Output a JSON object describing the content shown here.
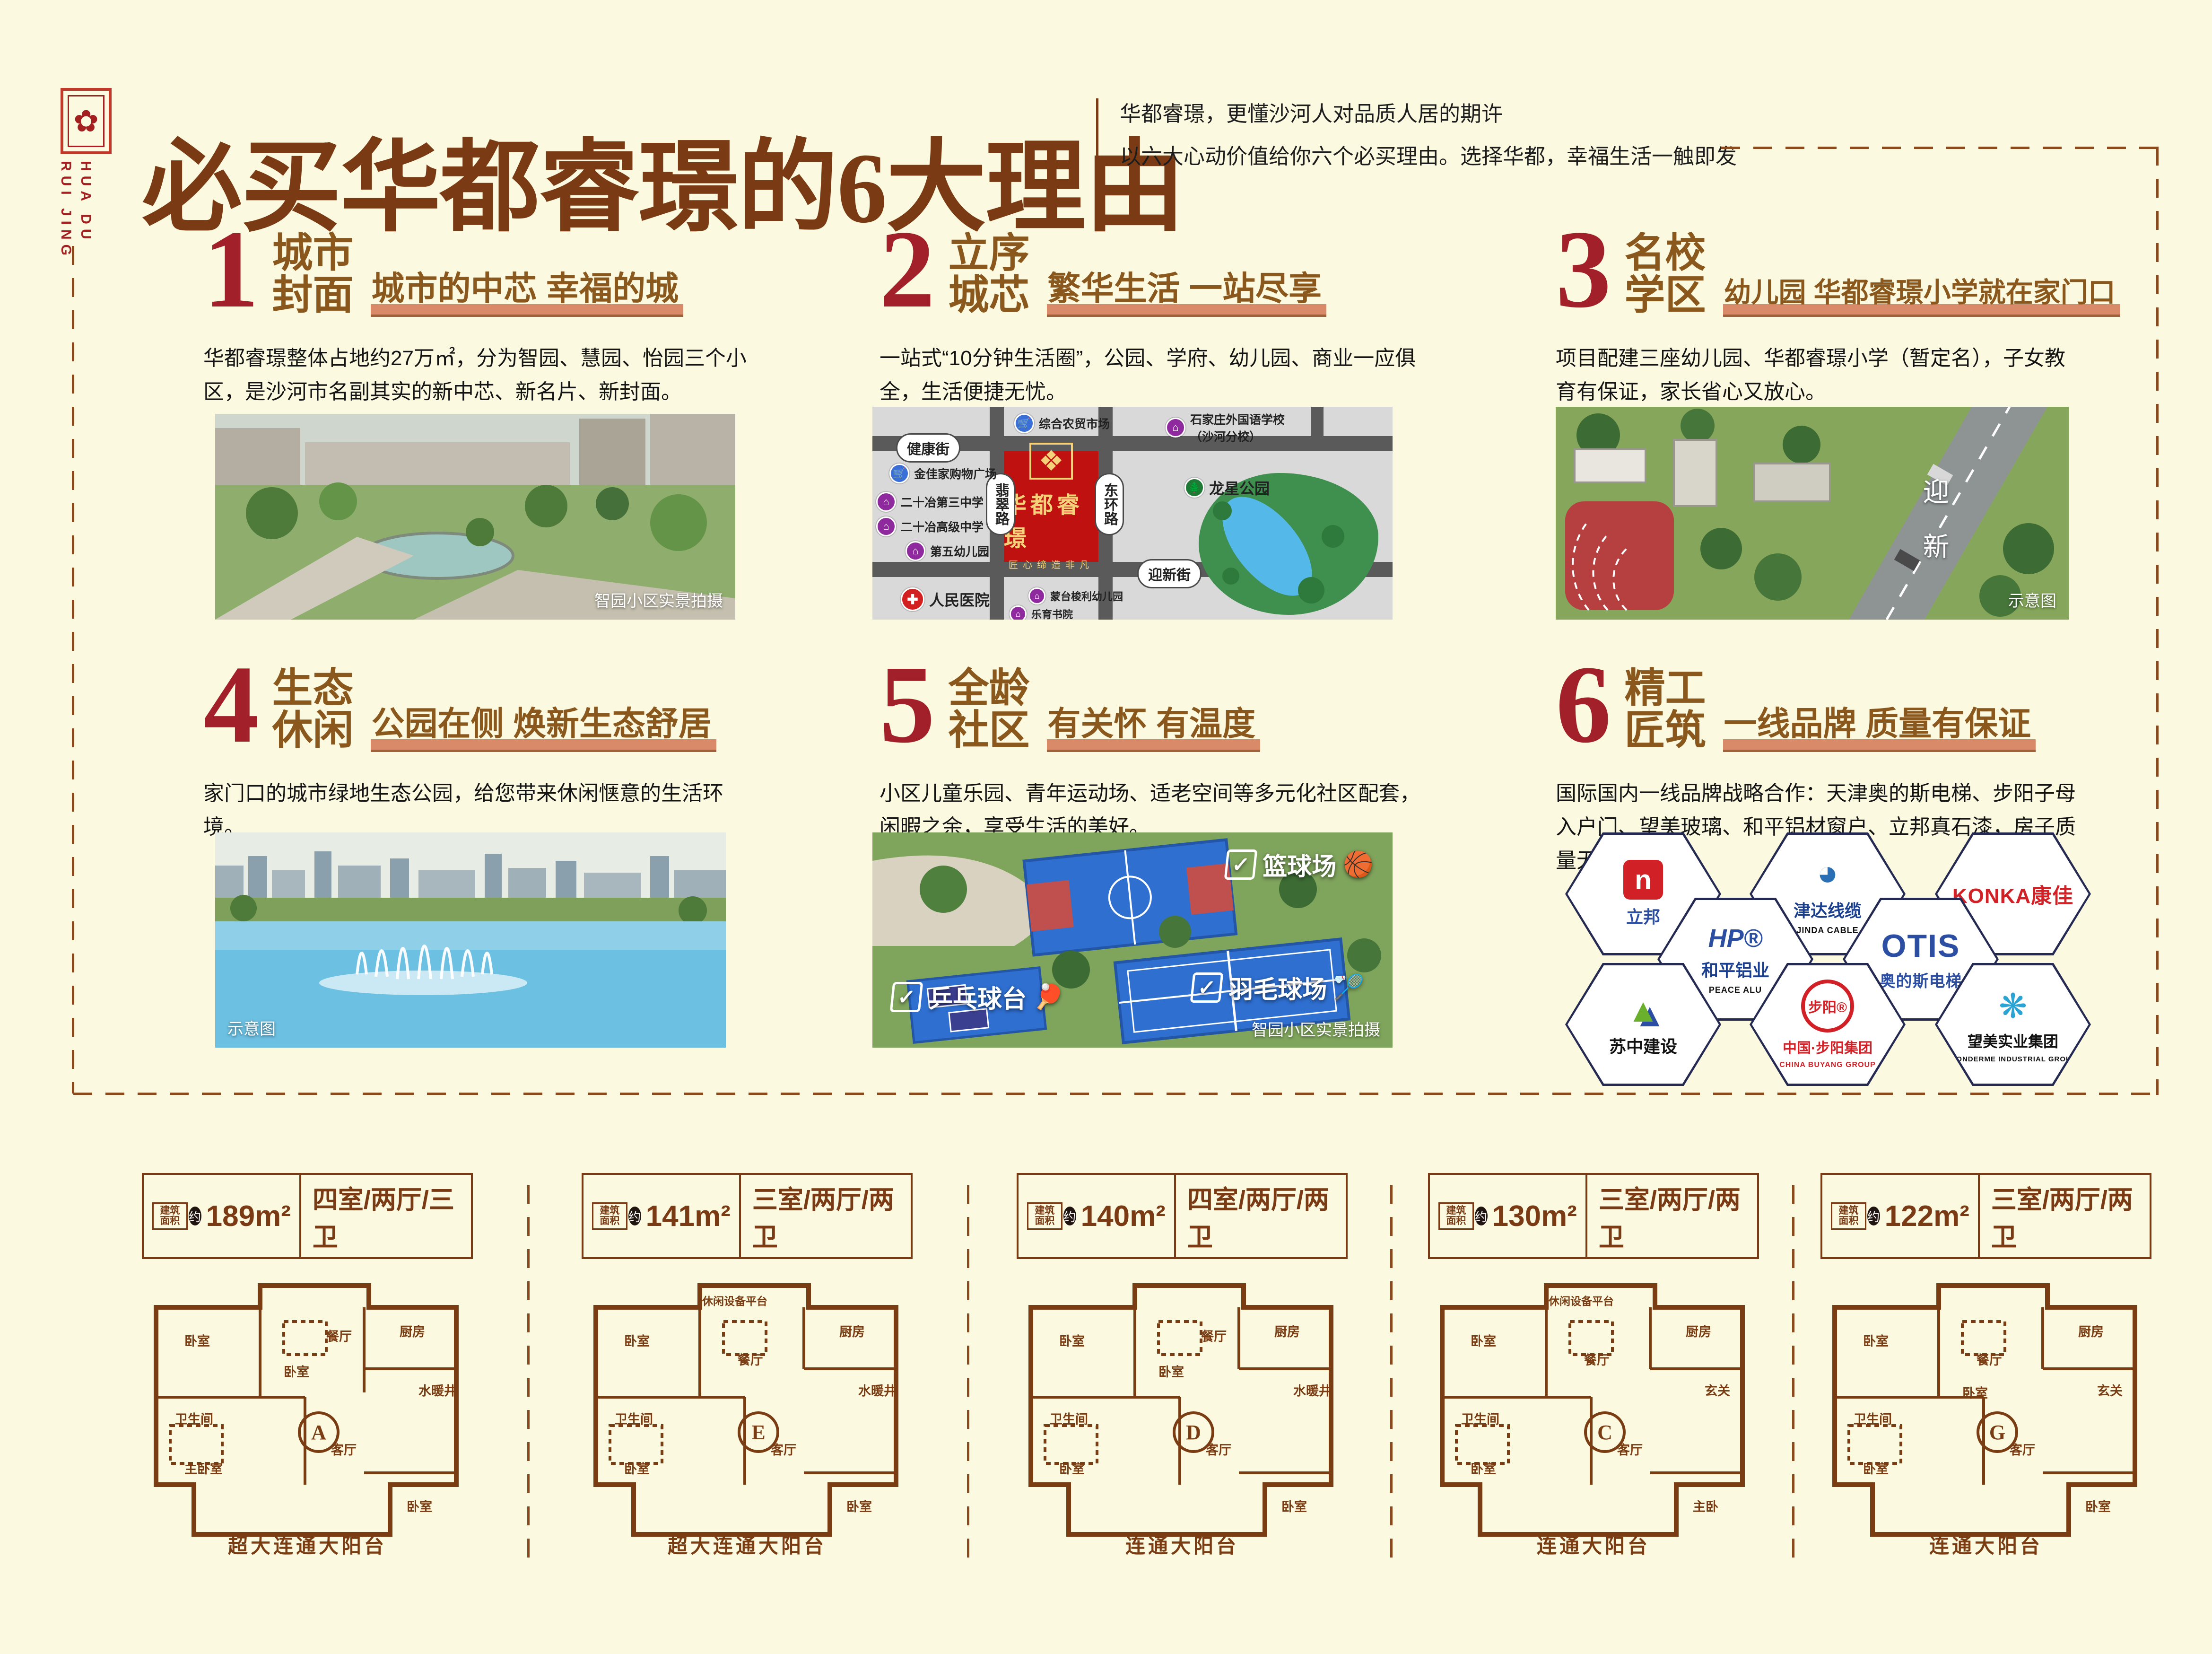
{
  "brand": {
    "seal_glyph": "✿",
    "name_vertical": "HUA DU\nRUI JING"
  },
  "header": {
    "title": "必买华都睿璟的6大理由",
    "subtitle_line1": "华都睿璟，更懂沙河人对品质人居的期许",
    "subtitle_line2": "以六大心动价值给你六个必买理由。选择华都，幸福生活一触即发"
  },
  "sections": [
    {
      "number": "1",
      "title1": "城市",
      "title2": "封面",
      "slogan": "城市的中芯 幸福的城",
      "body": "华都睿璟整体占地约27万㎡，分为智园、慧园、怡园三个小区，是沙河市名副其实的新中芯、新名片、新封面。",
      "caption": "智园小区实景拍摄"
    },
    {
      "number": "2",
      "title1": "立序",
      "title2": "城芯",
      "slogan": "繁华生活 一站尽享",
      "body": "一站式“10分钟生活圈”，公园、学府、幼儿园、商业一应俱全，生活便捷无忧。"
    },
    {
      "number": "3",
      "title1": "名校",
      "title2": "学区",
      "slogan": "幼儿园 华都睿璟小学就在家门口",
      "body": "项目配建三座幼儿园、华都睿璟小学（暂定名），子女教育有保证，家长省心又放心。",
      "caption": "示意图",
      "road_text": "迎新"
    },
    {
      "number": "4",
      "title1": "生态",
      "title2": "休闲",
      "slogan": "公园在侧 焕新生态舒居",
      "body": "家门口的城市绿地生态公园，给您带来休闲惬意的生活环境。",
      "caption": "示意图"
    },
    {
      "number": "5",
      "title1": "全龄",
      "title2": "社区",
      "slogan": "有关怀 有温度",
      "body": "小区儿童乐园、青年运动场、适老空间等多元化社区配套，闲暇之余，享受生活的美好。",
      "caption": "智园小区实景拍摄",
      "labels": [
        "篮球场",
        "羽毛球场",
        "乒乓球台"
      ],
      "label_icons": [
        "🏀",
        "🏸",
        "🏓"
      ],
      "check": "✓"
    },
    {
      "number": "6",
      "title1": "精工",
      "title2": "匠筑",
      "slogan": "一线品牌 质量有保证",
      "body": "国际国内一线品牌战略合作：天津奥的斯电梯、步阳子母入户门、望美玻璃、和平铝材窗户、立邦真石漆，房子质量无瑕有保证。"
    }
  ],
  "map": {
    "project_name": "华都睿璟",
    "project_sub": "匠心缔造非凡",
    "project_emblem": "❖",
    "road_top": "健康街",
    "road_bottom": "迎新街",
    "road_left_vertical": "翡翠路",
    "road_right_vertical": "东环路",
    "pois": [
      {
        "label": "综合农贸市场",
        "color": "#3a6fd8",
        "glyph": "🛒"
      },
      {
        "label": "石家庄外国语学校\n（沙河分校）",
        "color": "#8e2a9e",
        "glyph": "⌂"
      },
      {
        "label": "金佳家购物广场",
        "color": "#3a6fd8",
        "glyph": "🛒"
      },
      {
        "label": "二十冶第三中学",
        "color": "#8e2a9e",
        "glyph": "⌂"
      },
      {
        "label": "二十冶高级中学",
        "color": "#8e2a9e",
        "glyph": "⌂"
      },
      {
        "label": "第五幼儿园",
        "color": "#8e2a9e",
        "glyph": "⌂"
      },
      {
        "label": "龙星公园",
        "color": "#1f7a35",
        "glyph": "🌲"
      },
      {
        "label": "人民医院",
        "color": "#d21f1f",
        "glyph": "✚"
      },
      {
        "label": "蒙台梭利幼儿园",
        "color": "#8e2a9e",
        "glyph": "⌂"
      },
      {
        "label": "乐育书院",
        "color": "#8e2a9e",
        "glyph": "⌂"
      }
    ]
  },
  "brands": [
    {
      "cn": "立邦",
      "en": "",
      "glyph": "n",
      "accent": "#d22027"
    },
    {
      "cn": "津达线缆",
      "en": "JINDA CABLE",
      "glyph": "◕",
      "accent": "#2b6fb5"
    },
    {
      "cn": "KONKA康佳",
      "en": "",
      "glyph": "",
      "accent": "#d22027"
    },
    {
      "cn": "和平铝业",
      "en": "PEACE ALU",
      "glyph": "HP®",
      "accent": "#2b4ea2"
    },
    {
      "cn": "OTIS",
      "en": "奥的斯电梯",
      "glyph": "",
      "accent": "#2b4ea2"
    },
    {
      "cn": "苏中建设",
      "en": "",
      "glyph": "▲",
      "accent": "#6ab02d"
    },
    {
      "cn": "中国·步阳集团",
      "en": "CHINA BUYANG GROUP",
      "glyph": "步阳®",
      "accent": "#d22027"
    },
    {
      "cn": "望美实业集团",
      "en": "WONDERME INDUSTRIAL GROUP",
      "glyph": "❋",
      "accent": "#2ba3d4"
    }
  ],
  "plans": [
    {
      "tag": "建筑面积",
      "approx": "约",
      "area": "189m²",
      "layout": "四室/两厅/三卫",
      "letter": "A",
      "balcony": "超大连通大阳台",
      "rooms": [
        "卧室",
        "卧室",
        "厨房",
        "卫生间",
        "餐厅",
        "水暖井",
        "主卧室",
        "客厅",
        "卧室"
      ]
    },
    {
      "tag": "建筑面积",
      "approx": "约",
      "area": "141m²",
      "layout": "三室/两厅/两卫",
      "letter": "E",
      "balcony": "超大连通大阳台",
      "rooms": [
        "卧室",
        "休闲设备平台",
        "厨房",
        "卫生间",
        "餐厅",
        "水暖井",
        "卧室",
        "客厅",
        "卧室"
      ]
    },
    {
      "tag": "建筑面积",
      "approx": "约",
      "area": "140m²",
      "layout": "四室/两厅/两卫",
      "letter": "D",
      "balcony": "连通大阳台",
      "rooms": [
        "卧室",
        "卧室",
        "厨房",
        "卫生间",
        "餐厅",
        "水暖井",
        "卧室",
        "客厅",
        "卧室"
      ]
    },
    {
      "tag": "建筑面积",
      "approx": "约",
      "area": "130m²",
      "layout": "三室/两厅/两卫",
      "letter": "C",
      "balcony": "连通大阳台",
      "rooms": [
        "卧室",
        "休闲设备平台",
        "厨房",
        "卫生间",
        "餐厅",
        "玄关",
        "卧室",
        "客厅",
        "主卧"
      ]
    },
    {
      "tag": "建筑面积",
      "approx": "约",
      "area": "122m²",
      "layout": "三室/两厅/两卫",
      "letter": "G",
      "balcony": "连通大阳台",
      "rooms": [
        "卧室",
        "厨房",
        "餐厅",
        "卫生间",
        "卧室",
        "玄关",
        "卧室",
        "客厅",
        "卧室"
      ]
    }
  ]
}
